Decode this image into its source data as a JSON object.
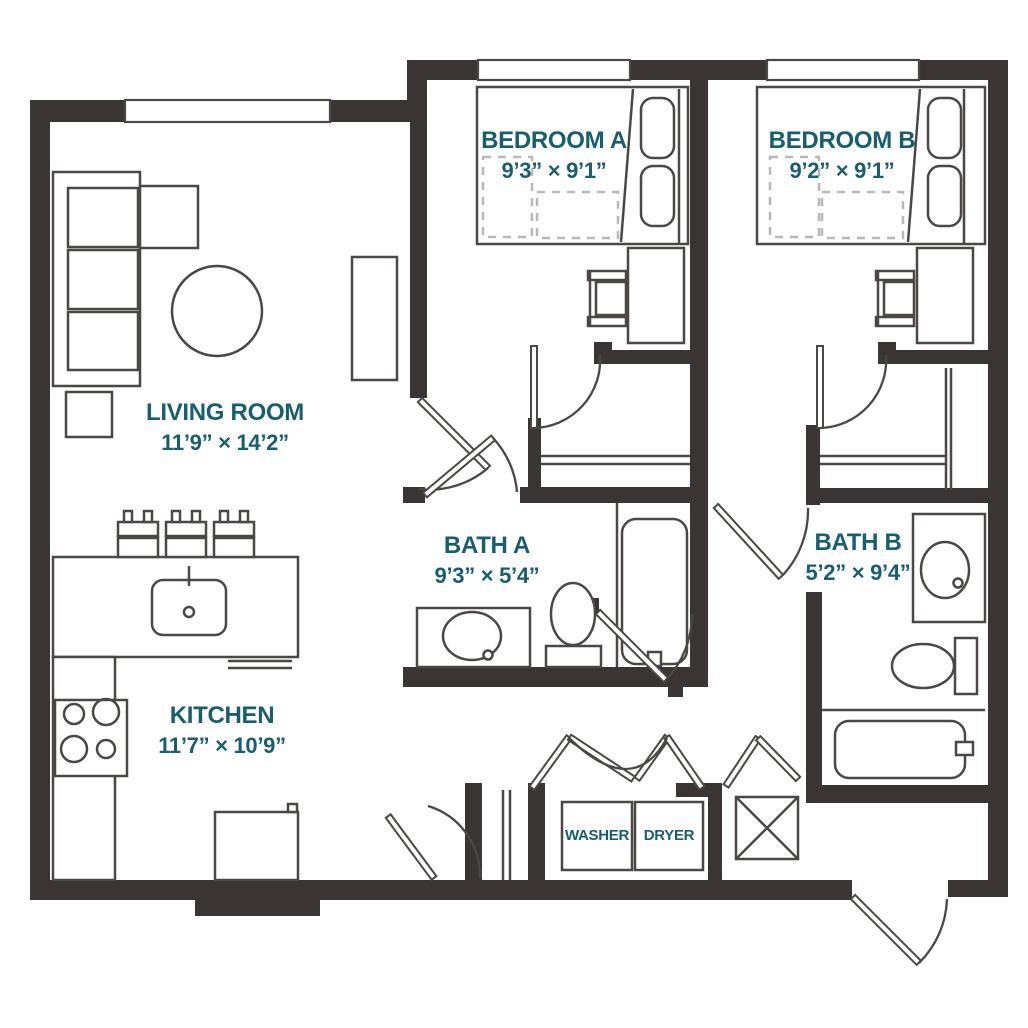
{
  "colors": {
    "wall": "#3a3534",
    "furniture_line": "#4b4744",
    "label_text": "#175e70",
    "dashed_line": "#b8b8b8",
    "background": "#ffffff"
  },
  "rooms": {
    "living_room": {
      "name": "LIVING ROOM",
      "dims": "11’9” × 14’2”"
    },
    "bedroom_a": {
      "name": "BEDROOM A",
      "dims": "9’3” × 9’1”"
    },
    "bedroom_b": {
      "name": "BEDROOM B",
      "dims": "9’2” × 9’1”"
    },
    "bath_a": {
      "name": "BATH A",
      "dims": "9’3” × 5’4”"
    },
    "bath_b": {
      "name": "BATH B",
      "dims": "5’2” × 9’4”"
    },
    "kitchen": {
      "name": "KITCHEN",
      "dims": "11’7” × 10’9”"
    }
  },
  "appliances": {
    "washer": "WASHER",
    "dryer": "DRYER"
  }
}
